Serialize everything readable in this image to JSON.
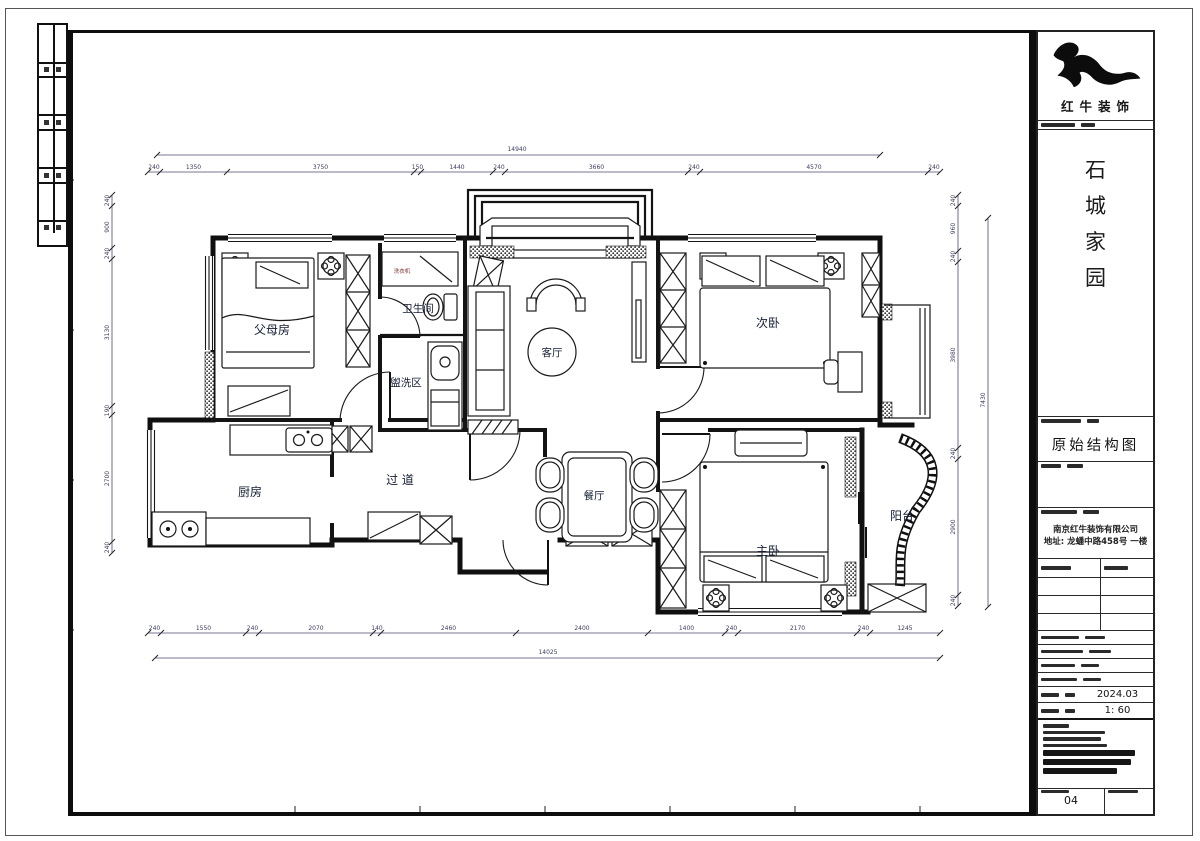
{
  "sheet": {
    "brand": "红牛装饰",
    "project_name_chars": [
      "石",
      "城",
      "家",
      "园"
    ],
    "drawing_title": "原始结构图",
    "company_name": "南京红牛装饰有限公司",
    "company_address": "地址: 龙蟠中路458号 一楼",
    "date_value": "2024.03",
    "scale_value": "1: 60",
    "sheet_number": "04"
  },
  "rooms": {
    "parents": "父母房",
    "bath": "卫生间",
    "wash": "盥洗区",
    "living": "客厅",
    "second": "次卧",
    "kitchen": "厨房",
    "corridor": "过 道",
    "dining": "餐厅",
    "master": "主卧",
    "balcony": "阳台"
  },
  "labels": {
    "washer": "洗衣机"
  },
  "dims": {
    "top_overall": "14940",
    "top_segments": [
      "240",
      "1350",
      "3750",
      "150",
      "1440",
      "240",
      "3660",
      "240",
      "4570",
      "240"
    ],
    "bottom_overall": "14025",
    "bottom_segments": [
      "240",
      "1550",
      "240",
      "2070",
      "140",
      "2460",
      "2400",
      "1400",
      "240",
      "2170",
      "240",
      "1245"
    ],
    "left_segments": [
      "240",
      "900",
      "240",
      "3130",
      "190",
      "2700",
      "240"
    ],
    "right_segments": [
      "240",
      "960",
      "240",
      "3980",
      "240",
      "2900",
      "240"
    ],
    "right_overall": "7430"
  }
}
